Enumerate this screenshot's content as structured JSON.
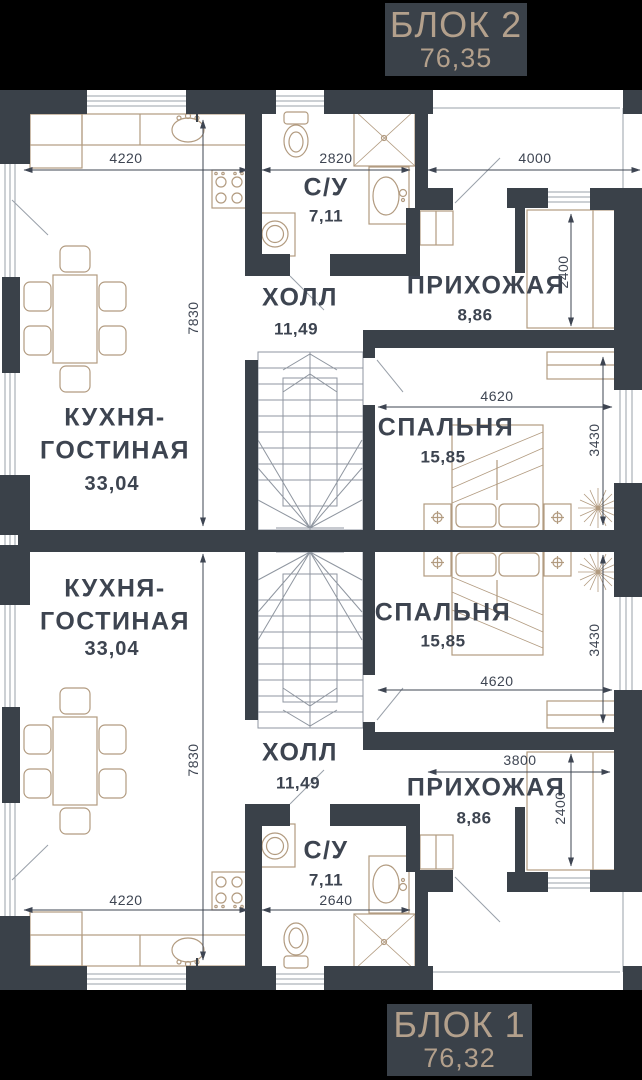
{
  "badges": {
    "block2": {
      "name": "БЛОК 2",
      "area": "76,35"
    },
    "block1": {
      "name": "БЛОК 1",
      "area": "76,32"
    }
  },
  "block2": {
    "kitchen_living": {
      "line1": "КУХНЯ-",
      "line2": "ГОСТИНАЯ",
      "area": "33,04"
    },
    "bathroom": {
      "name": "С/У",
      "area": "7,11"
    },
    "hall": {
      "name": "ХОЛЛ",
      "area": "11,49"
    },
    "entry": {
      "name": "ПРИХОЖАЯ",
      "area": "8,86"
    },
    "bedroom": {
      "name": "СПАЛЬНЯ",
      "area": "15,85"
    },
    "dims": {
      "kitchen_width": "4220",
      "kitchen_depth": "7830",
      "bathroom_width": "2820",
      "entry_width": "4000",
      "entry_depth": "2400",
      "bedroom_width": "4620",
      "bedroom_depth": "3430"
    }
  },
  "block1": {
    "kitchen_living": {
      "line1": "КУХНЯ-",
      "line2": "ГОСТИНАЯ",
      "area": "33,04"
    },
    "bathroom": {
      "name": "С/У",
      "area": "7,11"
    },
    "hall": {
      "name": "ХОЛЛ",
      "area": "11,49"
    },
    "entry": {
      "name": "ПРИХОЖАЯ",
      "area": "8,86"
    },
    "bedroom": {
      "name": "СПАЛЬНЯ",
      "area": "15,85"
    },
    "dims": {
      "kitchen_width": "4220",
      "kitchen_depth": "7830",
      "bathroom_width": "2640",
      "entry_width": "3800",
      "entry_depth": "2400",
      "bedroom_width": "4620",
      "bedroom_depth": "3430"
    }
  },
  "colors": {
    "background": "#000000",
    "floor": "#ffffff",
    "wall": "#3a4149",
    "label": "#3d4450",
    "furniture": "#b29b80",
    "badge_text": "#b3a08c"
  }
}
